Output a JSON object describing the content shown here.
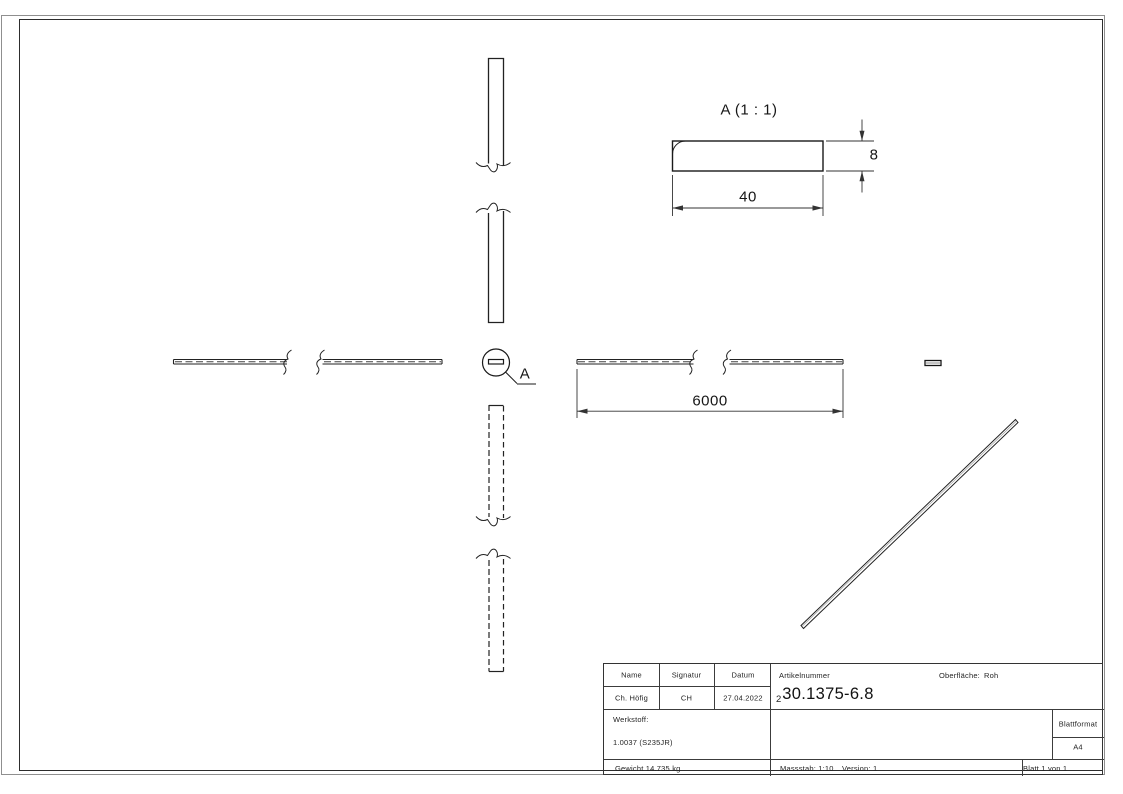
{
  "views": {
    "detail_title": "A (1 : 1)",
    "detail_width_dim": "40",
    "detail_height_dim": "8",
    "length_dim": "6000",
    "detail_marker_label": "A"
  },
  "title_block": {
    "name_header": "Name",
    "signatur_header": "Signatur",
    "datum_header": "Datum",
    "name_value": "Ch. Höfig",
    "signatur_value": "CH",
    "datum_value": "27.04.2022",
    "artikelnummer_label": "Artikelnummer",
    "artikelnummer_prefix": "2",
    "artikelnummer_value": "30.1375-6.8",
    "oberflaeche_label": "Oberfläche:",
    "oberflaeche_value": "Roh",
    "werkstoff_label": "Werkstoff:",
    "werkstoff_value": "1.0037 (S235JR)",
    "blattformat_label": "Blattformat",
    "blattformat_value": "A4",
    "gewicht_value": "Gewicht 14.735 kg",
    "massstab_value": "Massstab: 1:10",
    "version_value": "Version: 1",
    "blatt_value": "Blatt 1 von 1"
  },
  "colors": {
    "line": "#222222",
    "dim_line": "#333333",
    "page_edge": "#8f8f8f"
  }
}
